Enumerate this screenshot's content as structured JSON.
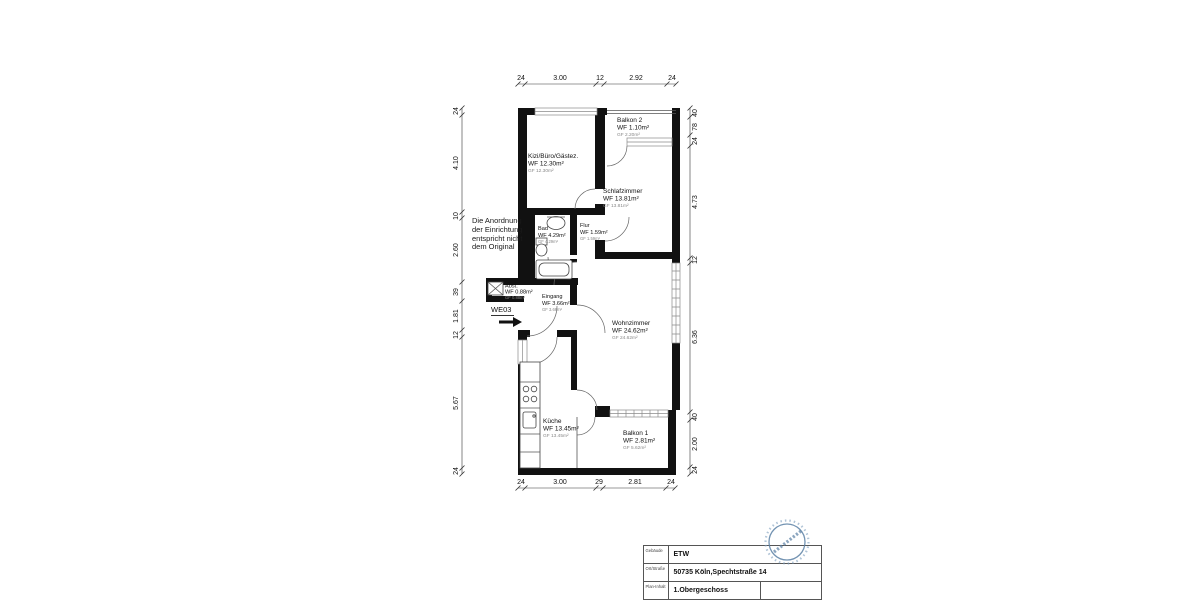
{
  "plan": {
    "note": "Die Anordnung\nder Einrichtung\nentspricht nicht\ndem Original",
    "entrance_label": "WE03",
    "rooms": [
      {
        "name": "Kizi/Büro/Gästez.",
        "wf": "WF 12.30m²",
        "gf": "GF 12.30m²"
      },
      {
        "name": "Balkon 2",
        "wf": "WF 1.10m²",
        "gf": "GF 2.20m²"
      },
      {
        "name": "Schlafzimmer",
        "wf": "WF 13.81m²",
        "gf": "GF 13.81m²"
      },
      {
        "name": "Bad",
        "wf": "WF 4.29m²",
        "gf": "GF 4.29m²"
      },
      {
        "name": "Flur",
        "wf": "WF 1.59m²",
        "gf": "GF 1.59m²"
      },
      {
        "name": "Abst.",
        "wf": "WF 0.88m²",
        "gf": "GF 0.88m²"
      },
      {
        "name": "Eingang",
        "wf": "WF 3.66m²",
        "gf": "GF 3.66m²"
      },
      {
        "name": "Wohnzimmer",
        "wf": "WF 24.62m²",
        "gf": "GF 24.62m²"
      },
      {
        "name": "Küche",
        "wf": "WF 13.45m²",
        "gf": "GF 13.45m²"
      },
      {
        "name": "Balkon 1",
        "wf": "WF 2.81m²",
        "gf": "GF 5.62m²"
      }
    ],
    "dims": {
      "top": [
        "24",
        "3.00",
        "12",
        "2.92",
        "24"
      ],
      "bottom": [
        "24",
        "3.00",
        "29",
        "2.81",
        "24"
      ],
      "left": [
        "24",
        "4.10",
        "10",
        "2.60",
        "39",
        "1.81",
        "12",
        "5.67",
        "24"
      ],
      "right": [
        "40",
        "78",
        "24",
        "4.73",
        "12",
        "6.36",
        "40",
        "2.00",
        "24"
      ]
    }
  },
  "titleblock": {
    "rows": [
      {
        "label": "Gebäude",
        "value": "ETW"
      },
      {
        "label": "Ort/Straße",
        "value": "50735 Köln,Spechtstraße 14"
      },
      {
        "label": "Plan-Inhalt",
        "value": "1.Obergeschoss"
      }
    ]
  },
  "colors": {
    "wall": "#111111",
    "window": "#8a8a8a",
    "stamp": "#5b80a5",
    "gf_text": "#888888"
  }
}
